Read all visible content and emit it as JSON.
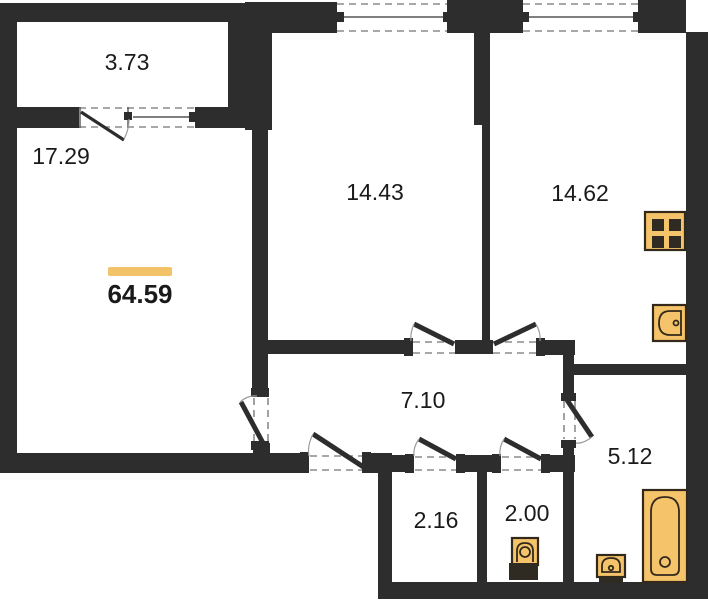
{
  "total_area": "64.59",
  "rooms": [
    {
      "id": "balcony",
      "area": "3.73"
    },
    {
      "id": "living-room",
      "area": "17.29"
    },
    {
      "id": "bedroom",
      "area": "14.43"
    },
    {
      "id": "kitchen",
      "area": "14.62"
    },
    {
      "id": "hallway",
      "area": "7.10"
    },
    {
      "id": "bathroom",
      "area": "5.12"
    },
    {
      "id": "storage",
      "area": "2.16"
    },
    {
      "id": "wc",
      "area": "2.00"
    }
  ],
  "fixtures": [
    "stove-icon",
    "kitchen-sink-icon",
    "bathtub-icon",
    "washbasin-icon",
    "toilet-icon"
  ],
  "colors": {
    "wall": "#2d2d2d",
    "fixture_fill": "#f5c46a",
    "fixture_stroke": "#32291b",
    "accent_bar": "#f2c268",
    "dash": "#8c8c8c",
    "arc": "#9b9b9b",
    "text": "#1a1a1a",
    "background": "#ffffff"
  }
}
